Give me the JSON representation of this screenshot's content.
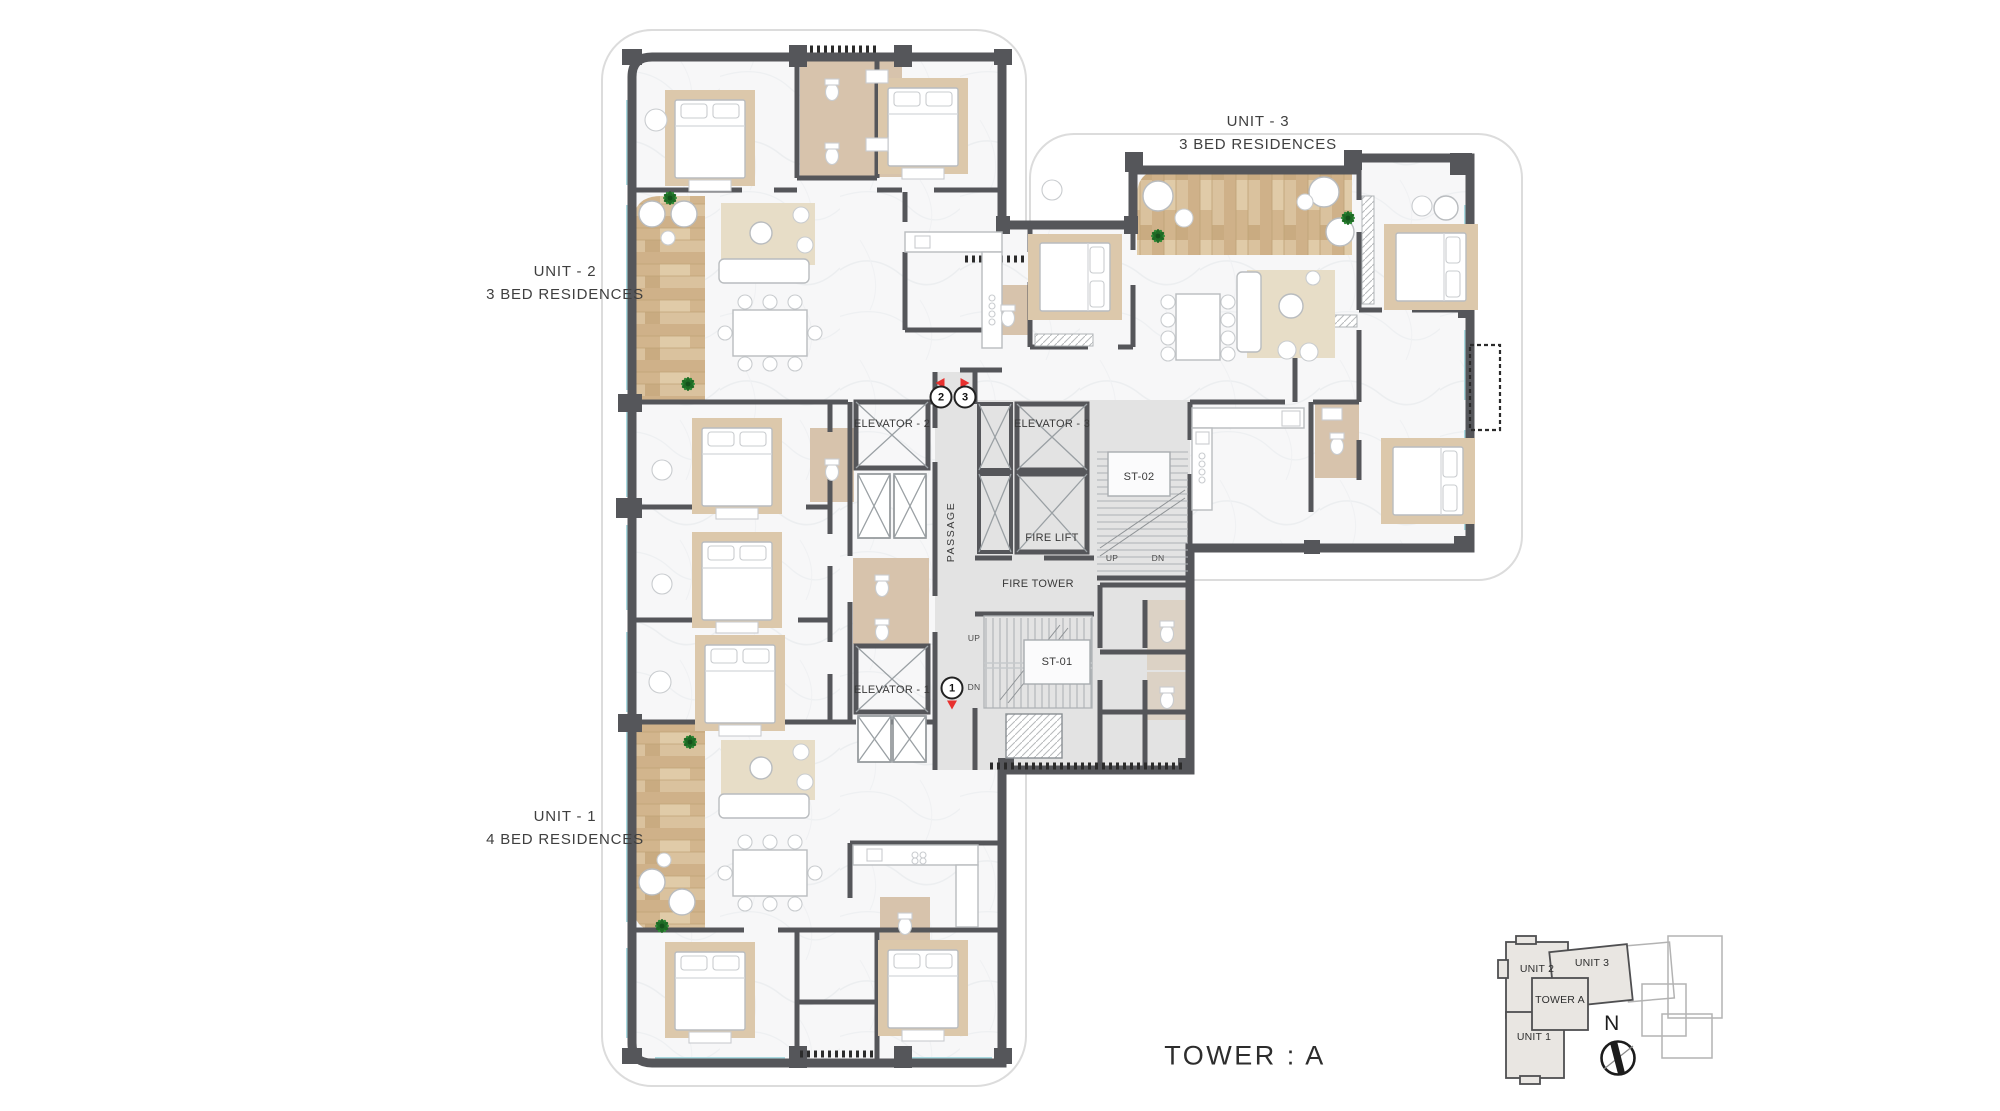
{
  "page": {
    "title": "TOWER : A"
  },
  "units": {
    "unit1": {
      "name": "UNIT - 1",
      "type": "4 BED RESIDENCES"
    },
    "unit2": {
      "name": "UNIT - 2",
      "type": "3 BED RESIDENCES"
    },
    "unit3": {
      "name": "UNIT - 3",
      "type": "3 BED RESIDENCES"
    }
  },
  "core": {
    "elevator1": "ELEVATOR - 1",
    "elevator2": "ELEVATOR - 2",
    "elevator3": "ELEVATOR - 3",
    "fire_lift": "FIRE LIFT",
    "fire_tower": "FIRE TOWER",
    "stair1": "ST-01",
    "stair2": "ST-02",
    "passage": "PASSAGE",
    "up": "UP",
    "dn": "DN"
  },
  "markers": {
    "unit1": "1",
    "unit2": "2",
    "unit3": "3"
  },
  "keyplan": {
    "unit1": "UNIT 1",
    "unit2": "UNIT 2",
    "unit3": "UNIT 3",
    "tower": "TOWER A",
    "north": "N"
  },
  "colors": {
    "wall": "#55565a",
    "marble_floor": "#f7f7f8",
    "core_floor": "#e3e3e3",
    "wood_deck": "#d6bc96",
    "bath_floor": "#d7c3ac",
    "window_glass": "#a9d9e0",
    "plant_green": "#2f8a36",
    "marker_red": "#e8302e",
    "keyplan_fill": "#e9e6e2"
  }
}
